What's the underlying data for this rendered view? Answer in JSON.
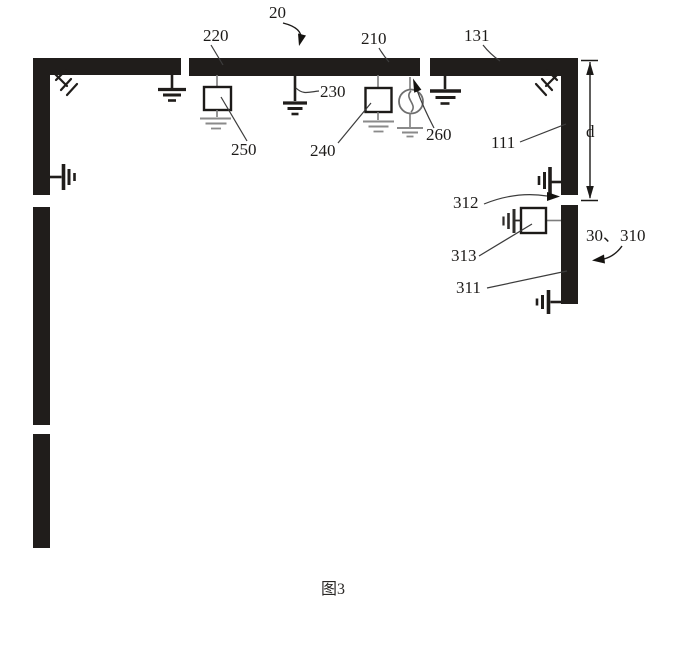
{
  "figure": {
    "caption": "图3",
    "labels": {
      "l20": "20",
      "l220": "220",
      "l210": "210",
      "l131": "131",
      "l230": "230",
      "l250": "250",
      "l240": "240",
      "l260": "260",
      "l111": "111",
      "ld": "d",
      "l312": "312",
      "l313": "313",
      "l30_310": "30、310",
      "l311": "311"
    },
    "colors": {
      "ink": "#201d1b",
      "leader": "#3c3c3c",
      "component_gray": "#7d7d7d"
    }
  }
}
